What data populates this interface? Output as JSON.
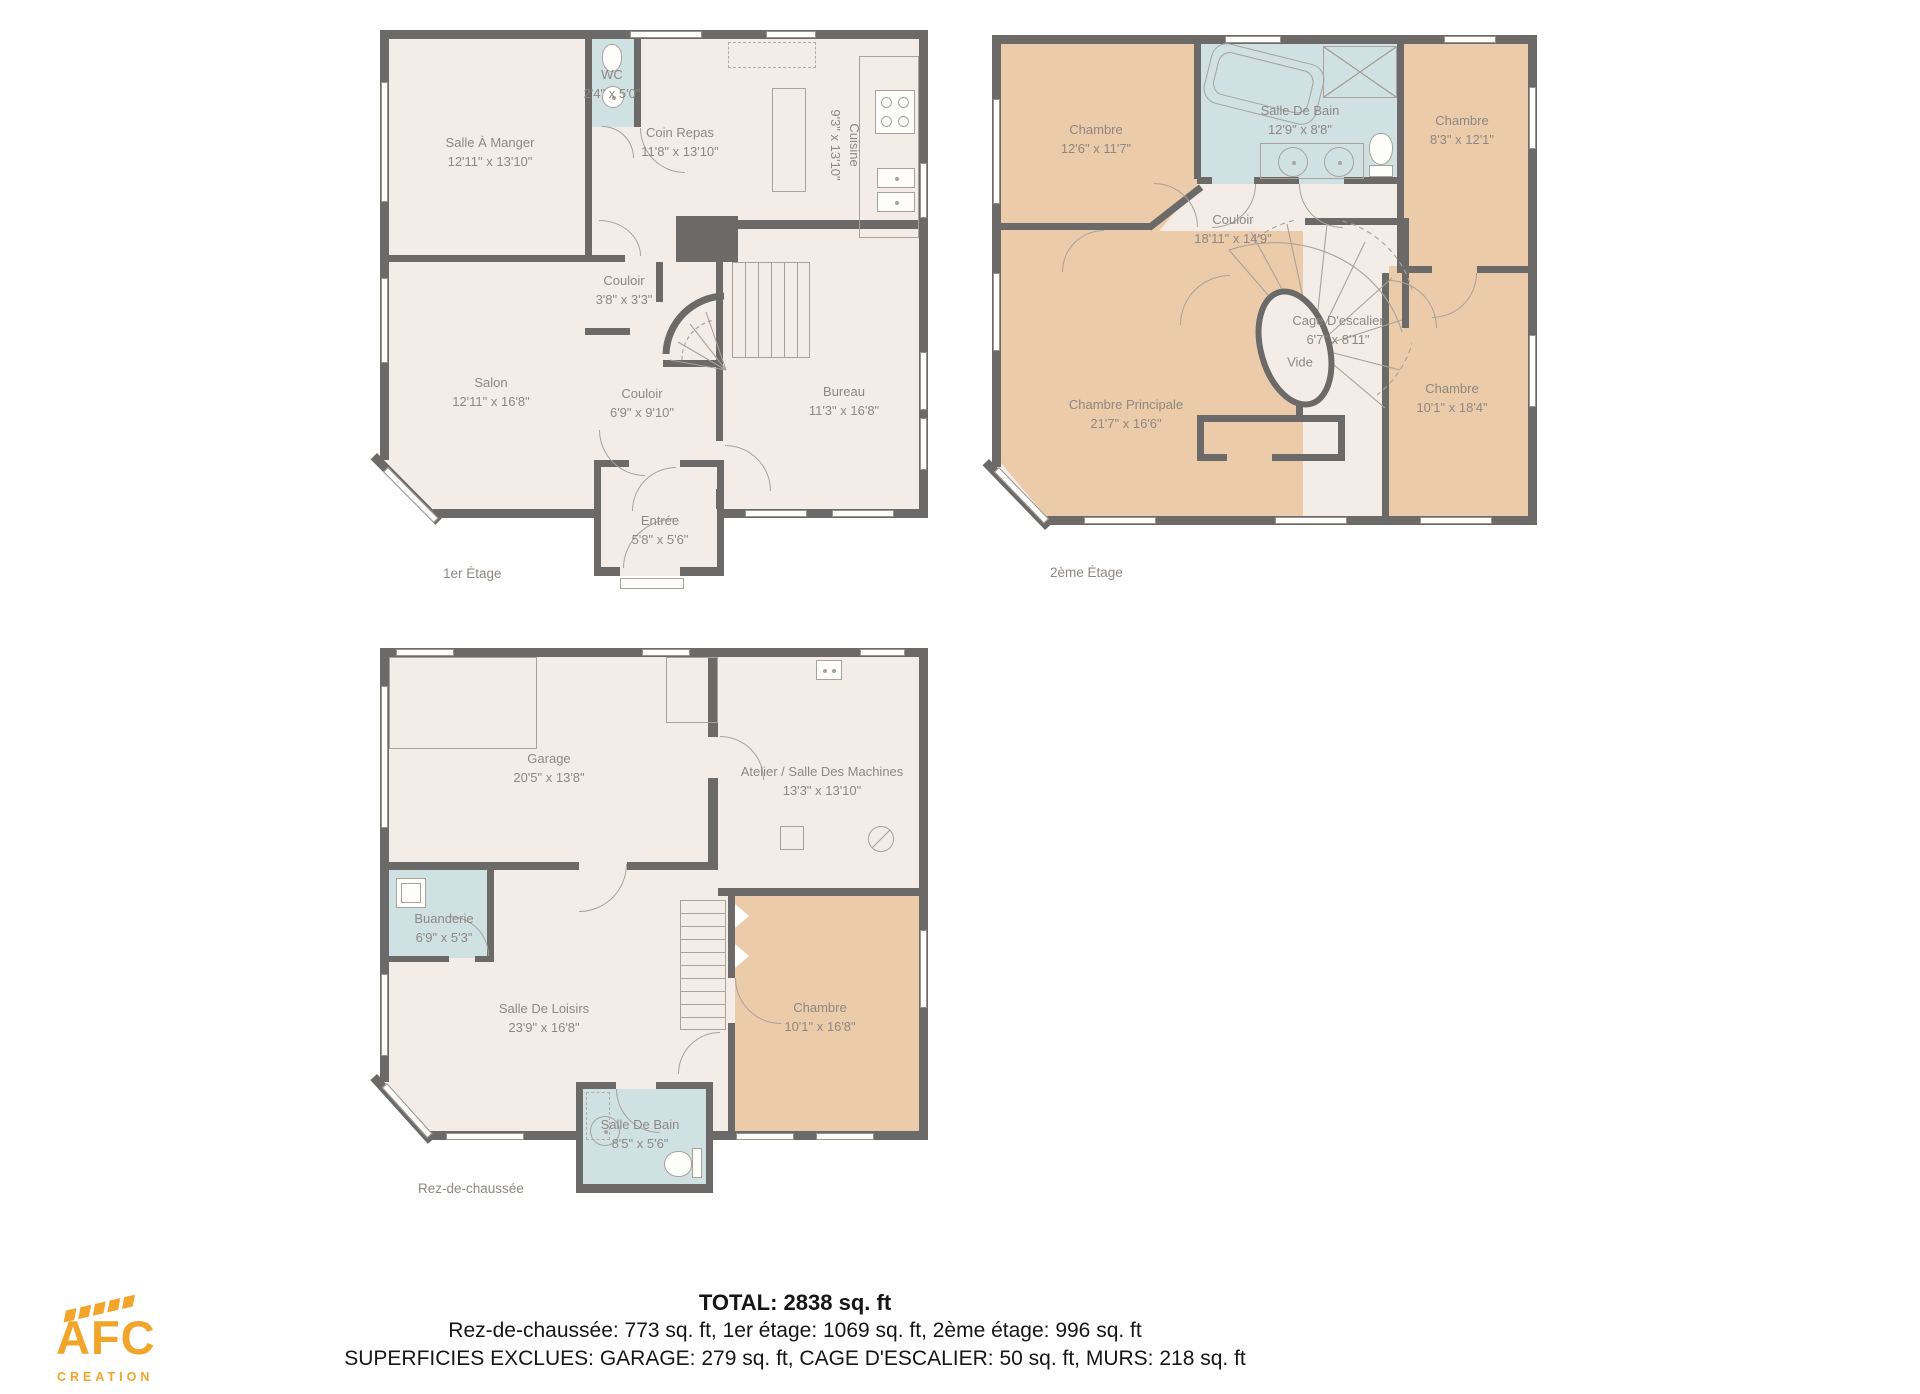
{
  "plans": [
    {
      "caption": "1er Étage",
      "rooms": [
        {
          "name": "Salle À Manger",
          "dims": "12'11\" x 13'10\""
        },
        {
          "name": "WC",
          "dims": "2'4\" x 5'0\""
        },
        {
          "name": "Coin Repas",
          "dims": "11'8\" x 13'10\""
        },
        {
          "name": "Cuisine",
          "dims": "9'3\" x 13'10\""
        },
        {
          "name": "Couloir",
          "dims": "3'8\" x 3'3\""
        },
        {
          "name": "Salon",
          "dims": "12'11\" x 16'8\""
        },
        {
          "name": "Couloir",
          "dims": "6'9\" x 9'10\""
        },
        {
          "name": "Bureau",
          "dims": "11'3\" x 16'8\""
        },
        {
          "name": "Entrée",
          "dims": "5'8\" x 5'6\""
        }
      ]
    },
    {
      "caption": "2ème Étage",
      "rooms": [
        {
          "name": "Chambre",
          "dims": "12'6\" x 11'7\""
        },
        {
          "name": "Salle De Bain",
          "dims": "12'9\" x 8'8\""
        },
        {
          "name": "Chambre",
          "dims": "8'3\" x 12'1\""
        },
        {
          "name": "Couloir",
          "dims": "18'11\" x 14'9\""
        },
        {
          "name": "Cage D'escalier",
          "dims": "6'7\" x 8'11\""
        },
        {
          "name": "Vide",
          "dims": ""
        },
        {
          "name": "Chambre Principale",
          "dims": "21'7\" x 16'6\""
        },
        {
          "name": "Chambre",
          "dims": "10'1\" x 18'4\""
        }
      ]
    },
    {
      "caption": "Rez-de-chaussée",
      "rooms": [
        {
          "name": "Garage",
          "dims": "20'5\" x 13'8\""
        },
        {
          "name": "Atelier / Salle Des Machines",
          "dims": "13'3\" x 13'10\""
        },
        {
          "name": "Buanderie",
          "dims": "6'9\" x 5'3\""
        },
        {
          "name": "Salle De Loisirs",
          "dims": "23'9\" x 16'8\""
        },
        {
          "name": "Chambre",
          "dims": "10'1\" x 16'8\""
        },
        {
          "name": "Salle De Bain",
          "dims": "8'5\" x 5'6\""
        }
      ]
    }
  ],
  "summary": {
    "total": "TOTAL: 2838 sq. ft",
    "floors": "Rez-de-chaussée: 773 sq. ft, 1er étage: 1069 sq. ft, 2ème étage: 996 sq. ft",
    "excluded": "SUPERFICIES EXCLUES: GARAGE: 279 sq. ft, CAGE D'ESCALIER: 50 sq. ft, MURS: 218 sq. ft"
  },
  "logo": {
    "name": "AFC",
    "subtitle": "CREATION",
    "color": "#f2a52b"
  },
  "colors": {
    "wall": "#6b6a68",
    "floor": "#f4ede7",
    "room_tan": "#ebcba9",
    "room_blue": "#cfe1e3",
    "label_text": "#8e8882",
    "logo_orange": "#f2a52b"
  }
}
